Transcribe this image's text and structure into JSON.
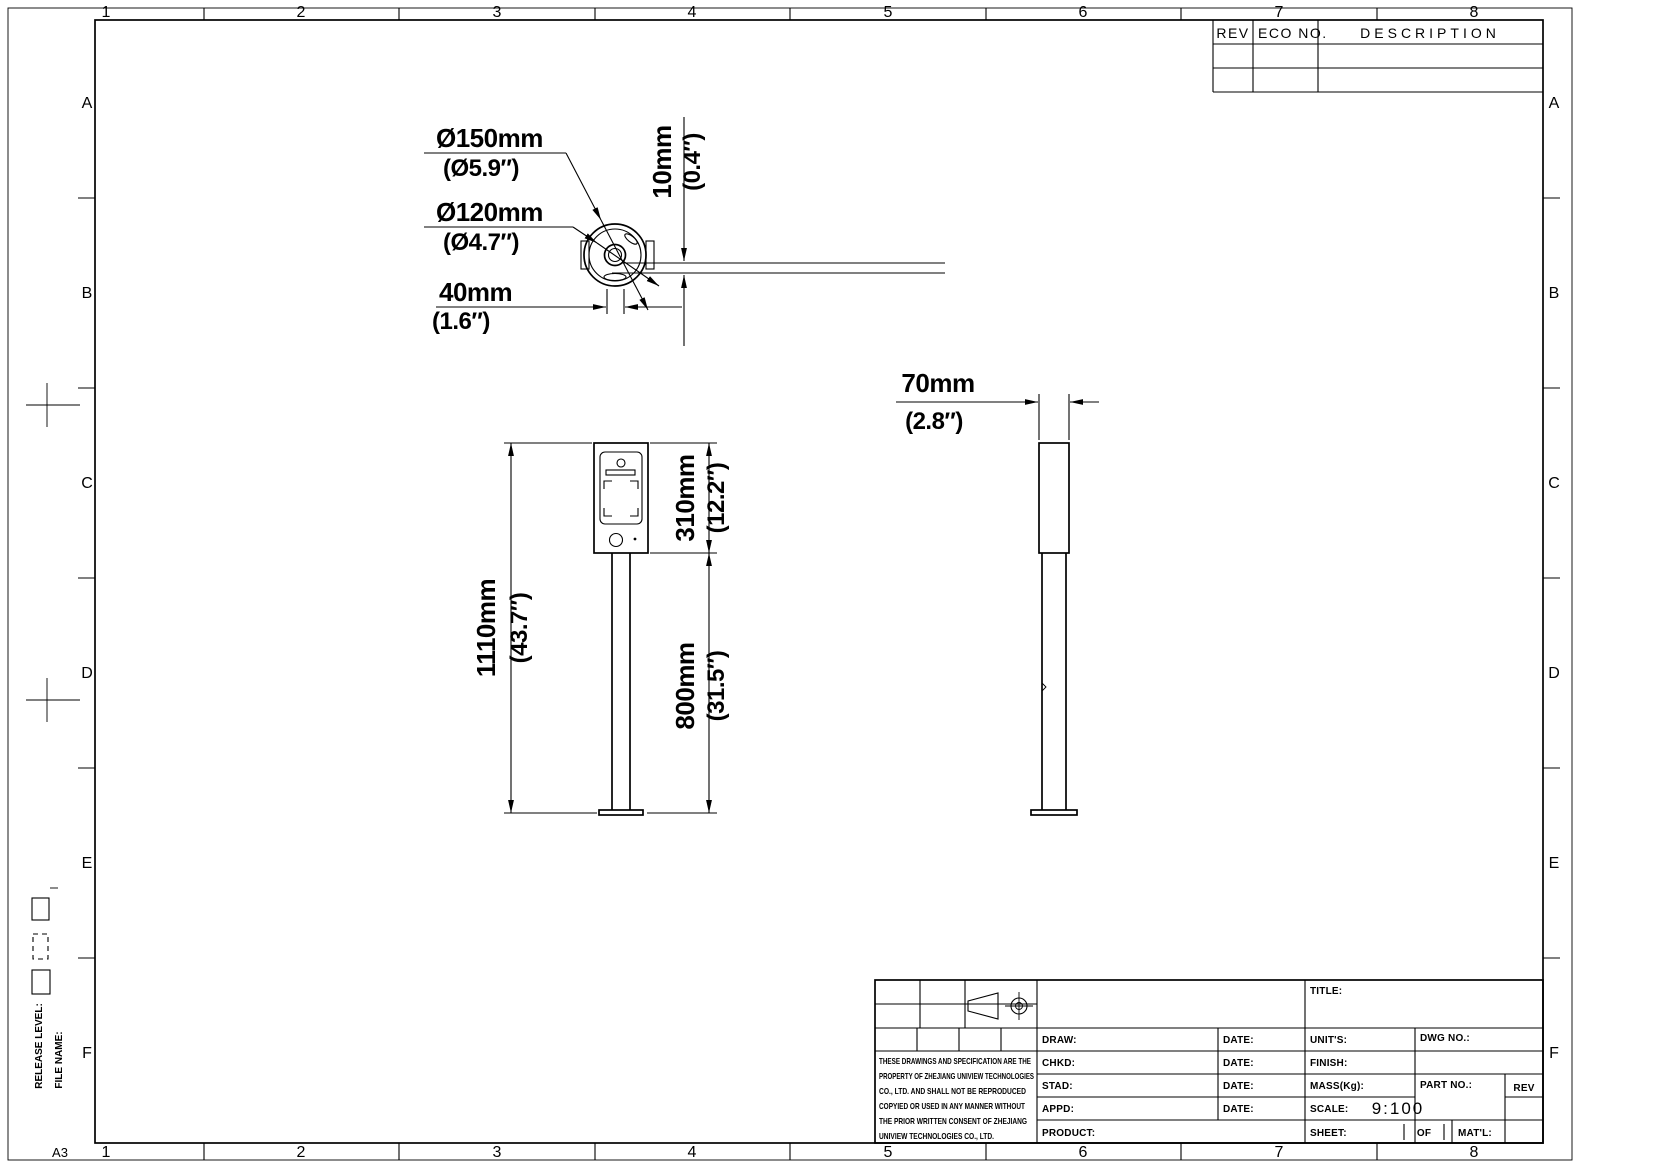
{
  "sheet": {
    "format": "A3",
    "grid_columns": [
      "1",
      "2",
      "3",
      "4",
      "5",
      "6",
      "7",
      "8"
    ],
    "grid_rows": [
      "A",
      "B",
      "C",
      "D",
      "E",
      "F"
    ],
    "release_level_label": "RELEASE LEVEL:",
    "file_name_label": "FILE NAME:"
  },
  "revision_table": {
    "rev_header": "REV",
    "eco_header": "ECO NO.",
    "description_header": "DESCRIPTION"
  },
  "views": {
    "top_view": {
      "dia150_mm": "Ø150mm",
      "dia150_in": "(Ø5.9″)",
      "dia120_mm": "Ø120mm",
      "dia120_in": "(Ø4.7″)",
      "width40_mm": "40mm",
      "width40_in": "(1.6″)",
      "thk10_mm": "10mm",
      "thk10_in": "(0.4″)"
    },
    "front_view": {
      "height310_mm": "310mm",
      "height310_in": "(12.2″)",
      "height1110_mm": "1110mm",
      "height1110_in": "(43.7″)",
      "height800_mm": "800mm",
      "height800_in": "(31.5″)"
    },
    "side_view": {
      "width70_mm": "70mm",
      "width70_in": "(2.8″)"
    }
  },
  "title_block": {
    "disclaimer": [
      "THESE DRAWINGS AND SPECIFICATION ARE THE",
      "PROPERTY OF ZHEJIANG UNIVIEW TECHNOLOGIES",
      "CO., LTD. AND SHALL NOT BE REPRODUCED",
      "COPYIED OR USED IN ANY MANNER WITHOUT",
      "THE PRIOR WRITTEN CONSENT OF ZHEJIANG",
      "UNIVIEW TECHNOLOGIES CO., LTD."
    ],
    "draw_label": "DRAW:",
    "chkd_label": "CHKD:",
    "stad_label": "STAD:",
    "appd_label": "APPD:",
    "product_label": "PRODUCT:",
    "date_label": "DATE:",
    "title_label": "TITLE:",
    "units_label": "UNIT'S:",
    "finish_label": "FINISH:",
    "mass_label": "MASS(Kg):",
    "scale_label": "SCALE:",
    "scale_value": "9:100",
    "sheet_label": "SHEET:",
    "of_label": "OF",
    "matl_label": "MAT'L:",
    "dwg_no_label": "DWG NO.:",
    "part_no_label": "PART NO.:",
    "rev_label": "REV"
  }
}
